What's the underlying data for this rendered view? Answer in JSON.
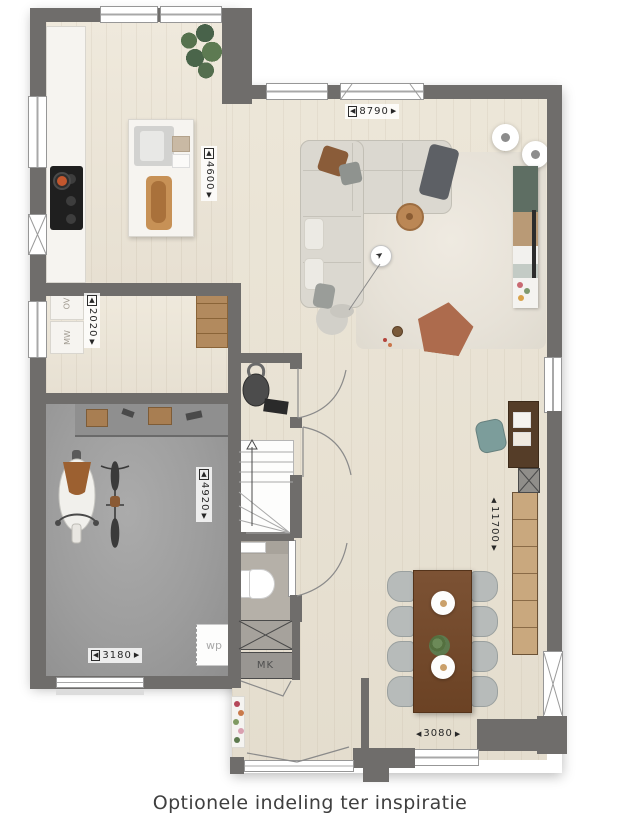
{
  "caption": "Optionele indeling ter inspiratie",
  "dimensions": {
    "kitchen_living_width": {
      "arrow_left": "◀",
      "value": "8790",
      "arrow_right": "▶"
    },
    "kitchen_depth": {
      "arrow_up": "▲",
      "value": "4600",
      "arrow_down": "▼"
    },
    "hallway_depth": {
      "arrow_up": "▲",
      "value": "2020",
      "arrow_down": "▼"
    },
    "garage_depth": {
      "arrow_up": "▲",
      "value": "4920",
      "arrow_down": "▼"
    },
    "garage_width": {
      "arrow_left": "◀",
      "value": "3180",
      "arrow_right": "▶"
    },
    "living_depth": {
      "arrow_up": "▲",
      "value": "11700",
      "arrow_down": "▼"
    },
    "living_width": {
      "arrow_left": "◀",
      "value": "3080",
      "arrow_right": "▶"
    }
  },
  "labels": {
    "heat_pump": "wp",
    "meter_cupboard": "MK",
    "oven": "OV",
    "microwave": "MW"
  },
  "colors": {
    "wall": "#6f6d6b",
    "wood_floor": "#e9e3d5",
    "garage_floor": "#9d9d9d",
    "pouf_terracotta": "#ad6b4d",
    "chair_teal": "#7c9d9b",
    "table_wood": "#6f4527"
  }
}
